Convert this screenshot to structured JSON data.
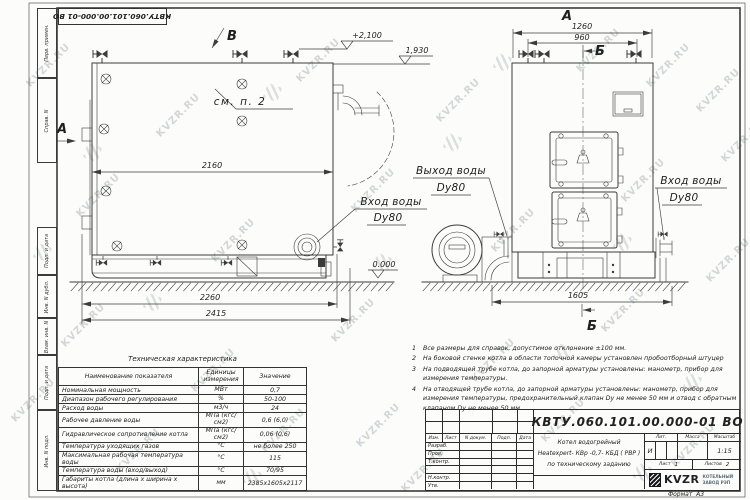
{
  "watermark": {
    "text": "KVZR.RU"
  },
  "stamp": {
    "doc_number": "КВТУ.060.101.00.000-01  ВО"
  },
  "margin_labels": [
    "Перв. примен.",
    "Справ. N",
    "Подп. и дата",
    "Инв. N дубл.",
    "Взам. инв. N",
    "Подп. и дата",
    "Инв. N подл."
  ],
  "views": {
    "left": {
      "view_label": "В",
      "side_label": "А",
      "see_note": "см. п. 2",
      "dim_body": "2160",
      "dim_base": "2260",
      "dim_total": "2415",
      "elev_top": "+2,100",
      "elev_zero": "0.000",
      "inlet_line1": "Вход воды",
      "inlet_line2": "Dy80"
    },
    "right": {
      "view_label": "А",
      "section_label": "Б",
      "dim_width": "1260",
      "dim_valves": "960",
      "dim_base": "1605",
      "elev_pipe": "1,930",
      "outlet_line1": "Выход воды",
      "outlet_line2": "Dy80",
      "inlet_line1": "Вход воды",
      "inlet_line2": "Dy80"
    }
  },
  "notes": {
    "items": [
      {
        "num": "1",
        "text": "Все размеры для справок, допустимое отклонение  ±100 мм."
      },
      {
        "num": "2",
        "text": "На боковой стенке котла в области топочной камеры установлен пробоотборный штуцер"
      },
      {
        "num": "3",
        "text": "На  подводящей трубе котла, до запорной арматуры установлены: манометр, прибор для измерения температуры."
      },
      {
        "num": "4",
        "text": "На отводящей трубе котла, до запорной арматуры установлены: манометр, прибор для измерения температуры, предохранительный клапан  Dу не менее 50 мм и отвод с обратным клапаном  Dу не менее 50 мм."
      }
    ]
  },
  "tech_table": {
    "title": "Техническая характеристика",
    "headers": [
      "Наименование показателя",
      "Единицы измерения",
      "Значение"
    ],
    "rows": [
      [
        "Номинальная мощность",
        "МВт",
        "0,7"
      ],
      [
        "Диапазон рабочего регулирования",
        "%",
        "50-100"
      ],
      [
        "Расход воды",
        "м3/ч",
        "24"
      ],
      [
        "Рабочее давление воды",
        "МПа (кгс/см2)",
        "0,6 (6,0)"
      ],
      [
        "Гидравлическое сопротивление котла",
        "МПа (кгс/см2)",
        "0,06 (0,6)"
      ],
      [
        "Температура уходящих газов",
        "°С",
        "не более 250"
      ],
      [
        "Максимальная рабочая температура воды",
        "°С",
        "115"
      ],
      [
        "Температура воды (вход/выход)",
        "°С",
        "70/95"
      ],
      [
        "Габариты котла (длина х ширина х высота)",
        "мм",
        "2385х1605х2117"
      ]
    ]
  },
  "title_block": {
    "doc_number": "КВТУ.060.101.00.000-01  ВО",
    "cols": [
      "Изм.",
      "Лист",
      "N докум.",
      "Подп.",
      "Дата"
    ],
    "rows": [
      "Разраб.",
      "Пров.",
      "Т.контр.",
      "",
      "Н.контр.",
      "Утв."
    ],
    "lit_label": "Лит.",
    "lit_value": "И",
    "mass_label": "Масса",
    "scale_label": "Масштаб",
    "scale_value": "1:15",
    "sheet_label": "Лист",
    "sheet_value": "1",
    "sheets_label": "Листов",
    "sheets_value": "2",
    "desc_line1": "Котел водогрейный",
    "desc_line2": "Heatexpert- КВр -0,7- КБД ( РВР )",
    "desc_line3": "по техническому заданию",
    "brand": "KVZR",
    "brand_sub1": "КОТЕЛЬНЫЙ",
    "brand_sub2": "ЗАВОД РЭП",
    "format": "Формат  А3"
  }
}
